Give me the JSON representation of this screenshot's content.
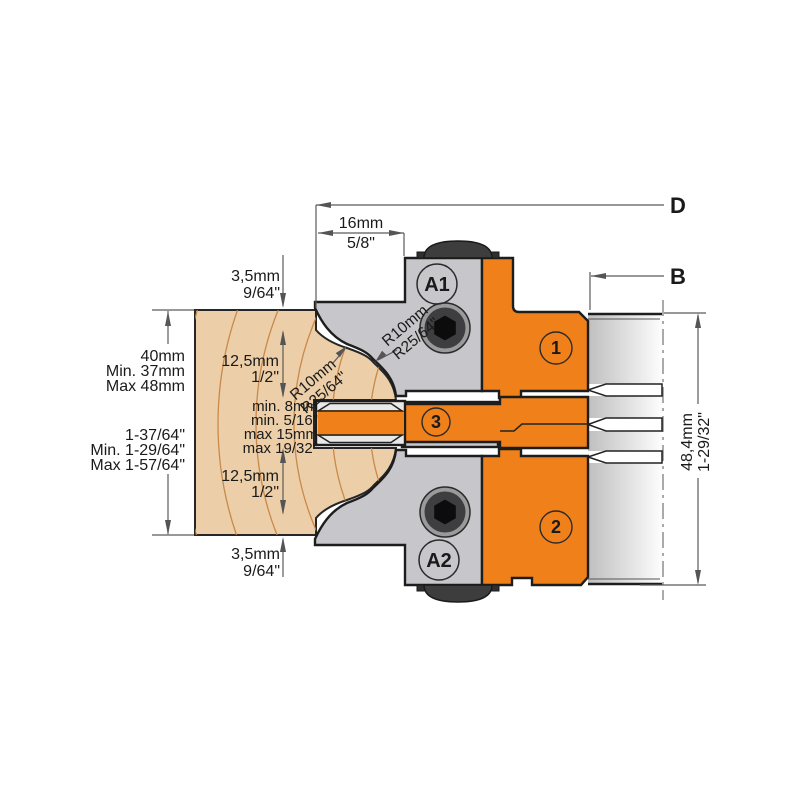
{
  "title": "Profile cutter head cross-section drawing",
  "colors": {
    "orange": "#F08019",
    "steel": "#C7C6CA",
    "steel_light": "#E9E9E9",
    "tip_band": "#D4D4D6",
    "wood": "#ECCFA8",
    "wood_line": "#C5813F",
    "screw_dark": "#3D3D3D",
    "outline": "#1D1D1D"
  },
  "labels": {
    "dim_d": "D",
    "dim_b": "B",
    "top_width": [
      "16mm",
      "5/8\""
    ],
    "step_top": [
      "3,5mm",
      "9/64\""
    ],
    "step_bottom": [
      "3,5mm",
      "9/64\""
    ],
    "half_upper": [
      "12,5mm",
      "1/2\""
    ],
    "half_lower": [
      "12,5mm",
      "1/2\""
    ],
    "groove": [
      "min. 8mm",
      "min. 5/16\"",
      "max 15mm",
      "max 19/32\""
    ],
    "stock_metric": [
      "40mm",
      "Min. 37mm",
      "Max 48mm"
    ],
    "stock_imperial": [
      "1-37/64\"",
      "Min. 1-29/64\"",
      "Max 1-57/64\""
    ],
    "overall_height": [
      "48,4mm",
      "1-29/32\""
    ],
    "radius_left": [
      "R10mm",
      "R25/64\""
    ],
    "radius_right": [
      "R10mm",
      "R25/64\""
    ],
    "badge_a1": "A1",
    "badge_a2": "A2",
    "part_1": "1",
    "part_2": "2",
    "part_3": "3"
  }
}
